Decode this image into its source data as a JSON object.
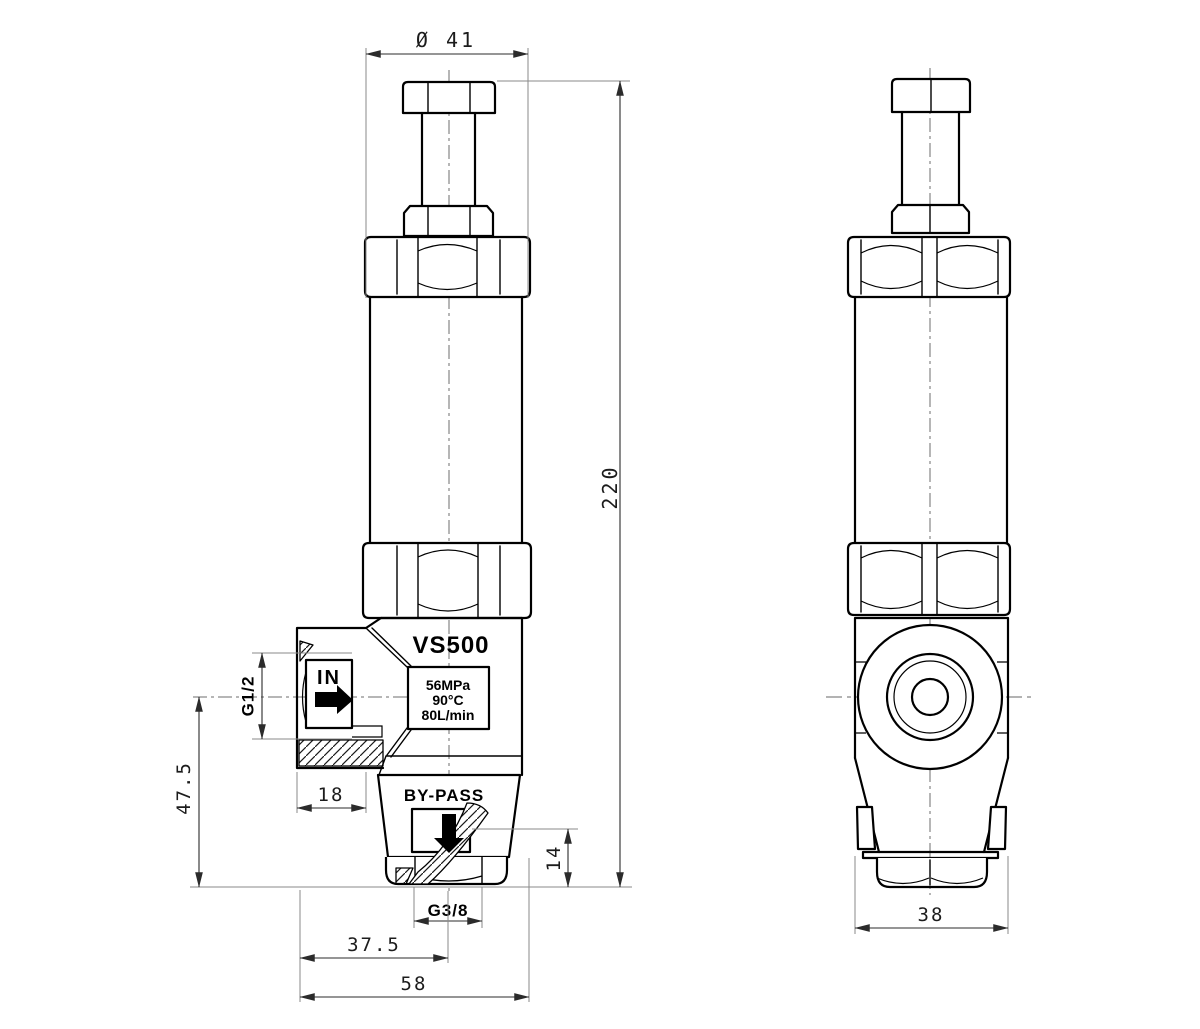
{
  "drawing_type": "valve-technical-drawing",
  "front_view": {
    "model_label": "VS500",
    "spec_box": {
      "pressure": "56MPa",
      "temperature": "90°C",
      "flow": "80L/min"
    },
    "inlet_label": "IN",
    "bypass_label": "BY-PASS",
    "dims": {
      "hex_flats_diameter": "Ø 41",
      "overall_height": "220",
      "inlet_thread": "G1/2",
      "inlet_axis_height": "47.5",
      "inlet_boss_depth": "18",
      "bypass_port_height": "14",
      "bypass_thread": "G3/8",
      "bypass_axis_offset": "37.5",
      "body_depth": "58"
    }
  },
  "side_view": {
    "dims": {
      "body_width": "38"
    }
  },
  "colors": {
    "outline": "#000000",
    "dimension_line": "#2b2b2b",
    "extension_line": "#8a8a8a",
    "centerline": "#6e6e6e",
    "background": "#ffffff"
  }
}
